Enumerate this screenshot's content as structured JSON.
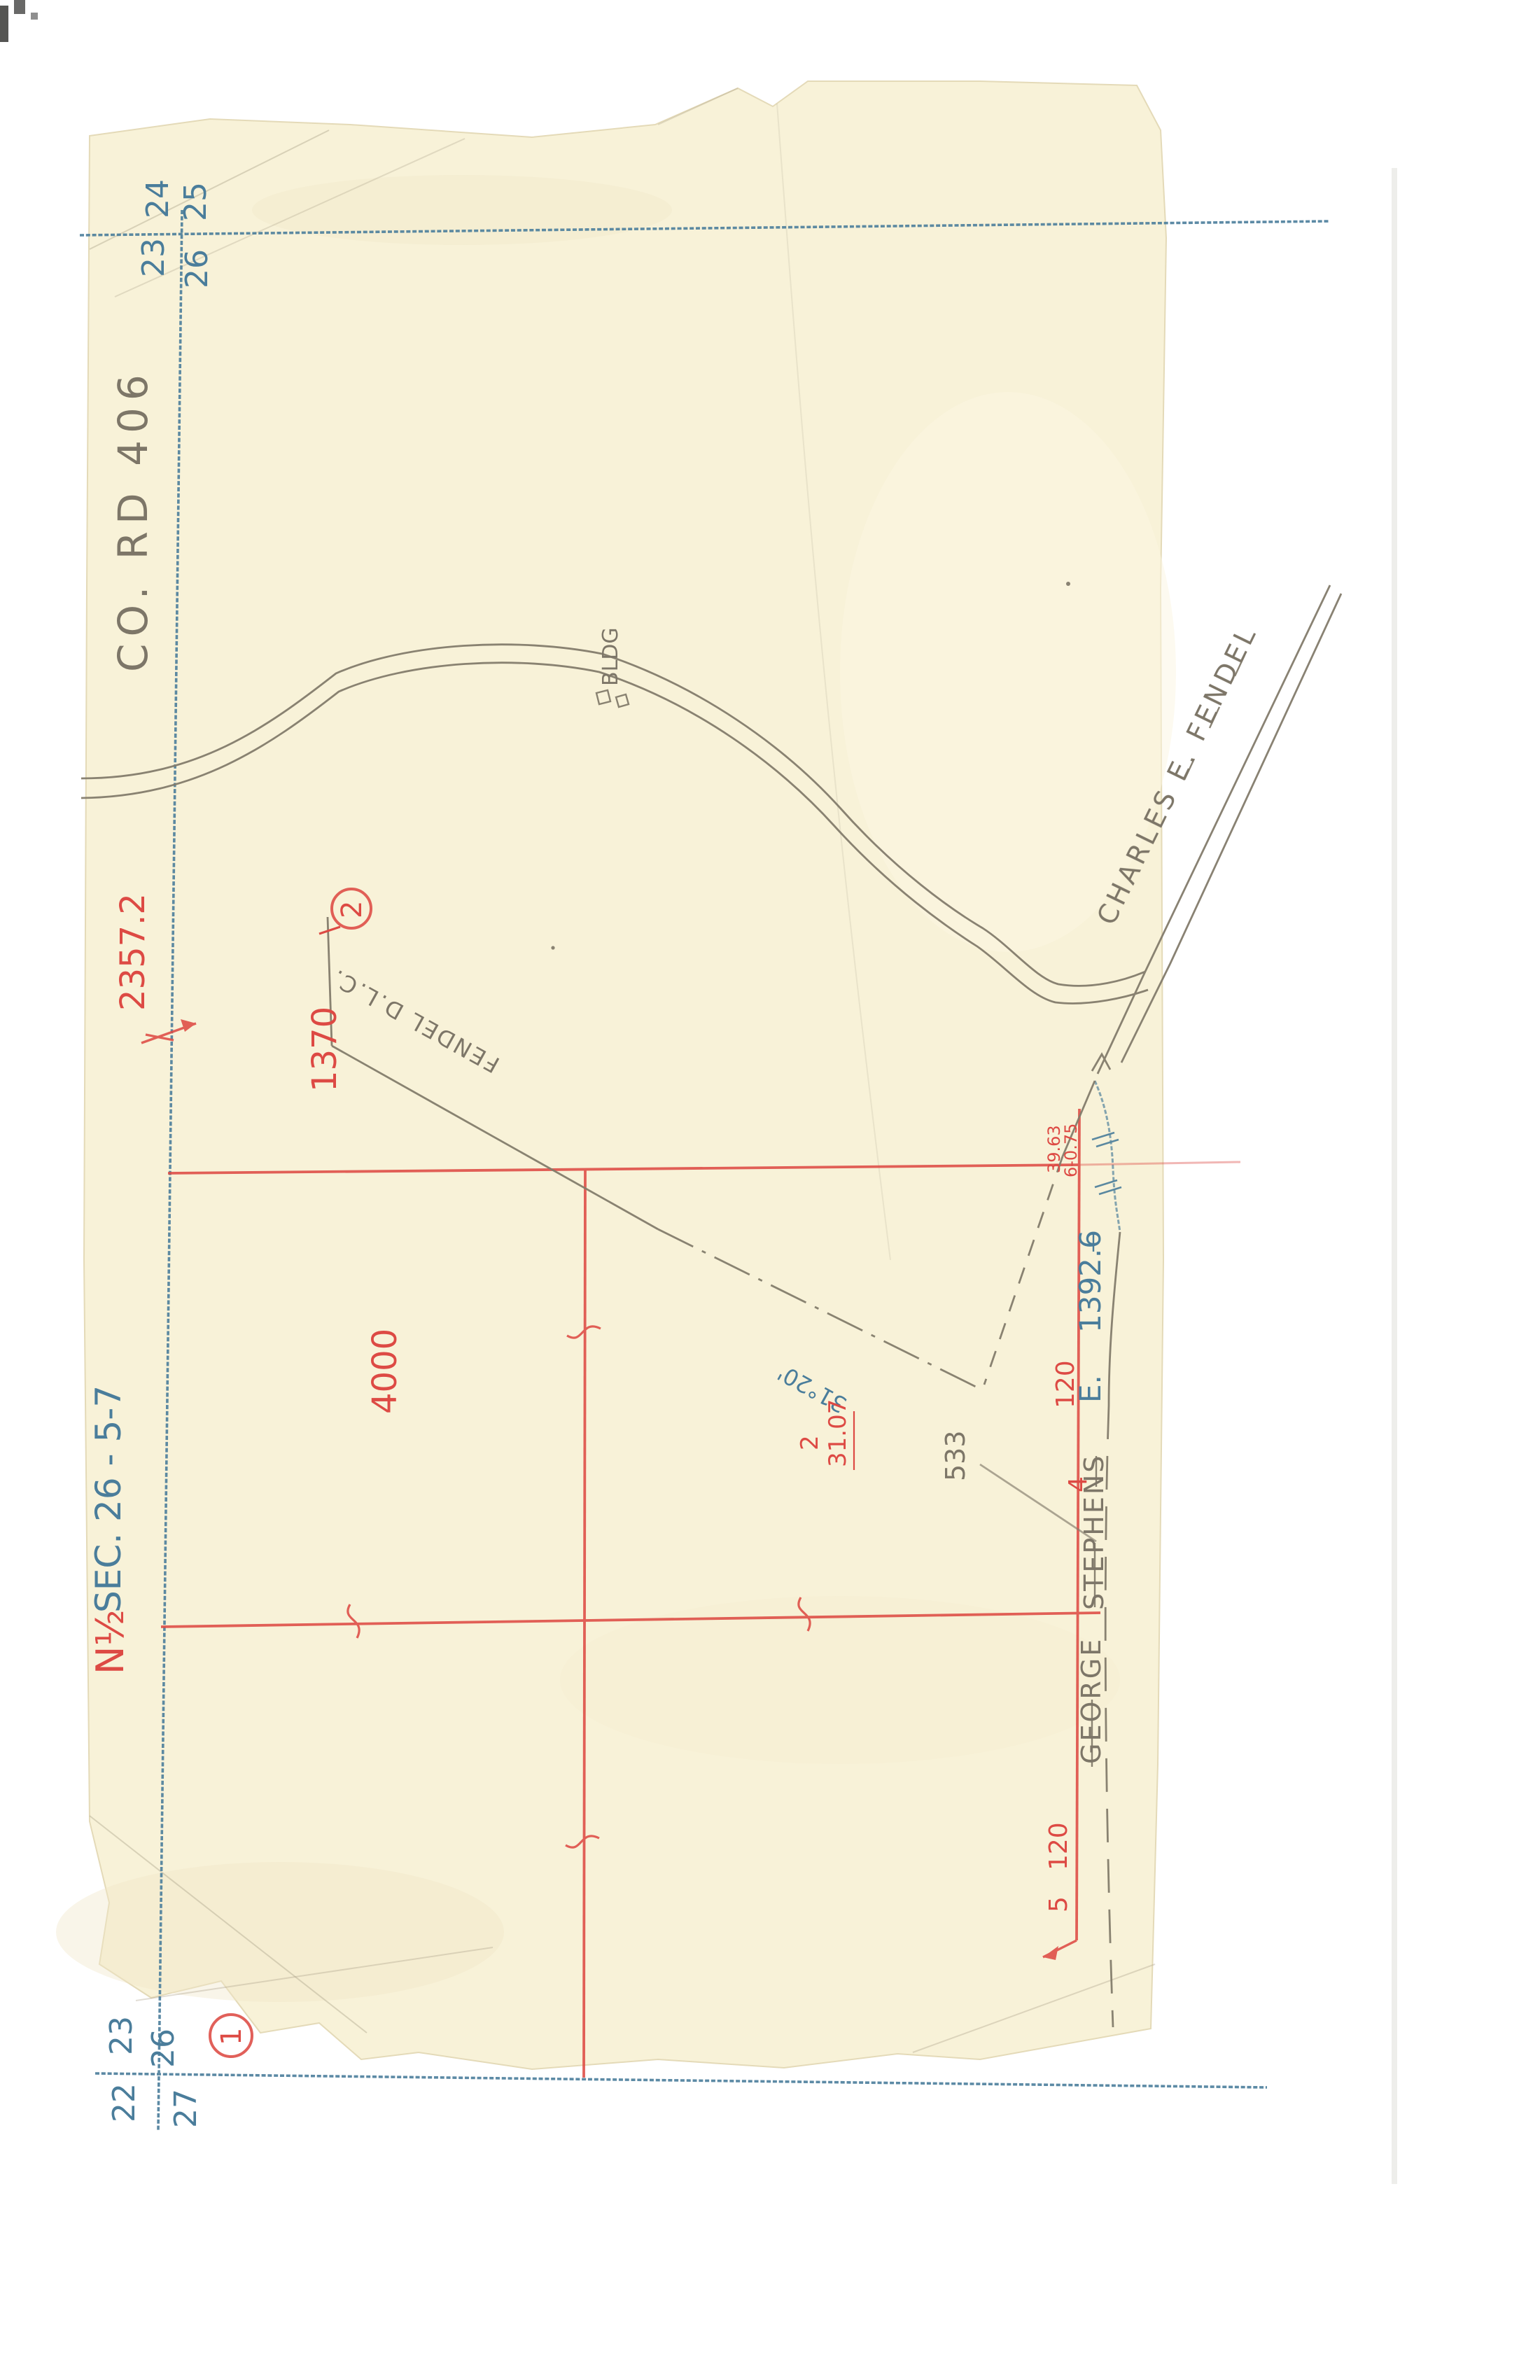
{
  "document_type": "scanned hand-drawn survey plat",
  "colors": {
    "paper": "#f8f2d8",
    "ink_blue": "#4a7d9b",
    "ink_red": "#dd4a44",
    "pencil": "#837c6c",
    "background": "#ffffff"
  },
  "map": {
    "road_label": "CO. RD 406",
    "road_owner": "CHARLES E. FENDEL",
    "dlc_label": "FENDEL D.L.C.",
    "bldg_label": "BLDG",
    "section_label_red": "N½",
    "section_label_blue": "SEC. 26 - 5-7",
    "owner_east_first": "GEORGE",
    "owner_east_last": "STEPHENS",
    "east_label": "E.",
    "east_value": "1392.6",
    "bearing": "31°20'",
    "parcel_1": "1",
    "parcel_2": "2",
    "dims": {
      "d2357": "2357.2",
      "d1370": "1370",
      "d4000": "4000",
      "d3107": "31.07",
      "d2": "2",
      "d533": "533",
      "d120_top": "120",
      "d4": "4",
      "d120_bottom": "120",
      "d5": "5",
      "tri_left": "39.63",
      "tri_right": "6-0.75"
    },
    "corners": {
      "top": {
        "nw": "24",
        "ne": "25",
        "sw": "23",
        "se": "26"
      },
      "bottom": {
        "nw": "23",
        "ne": "26",
        "sw": "22",
        "se": "27"
      }
    }
  }
}
